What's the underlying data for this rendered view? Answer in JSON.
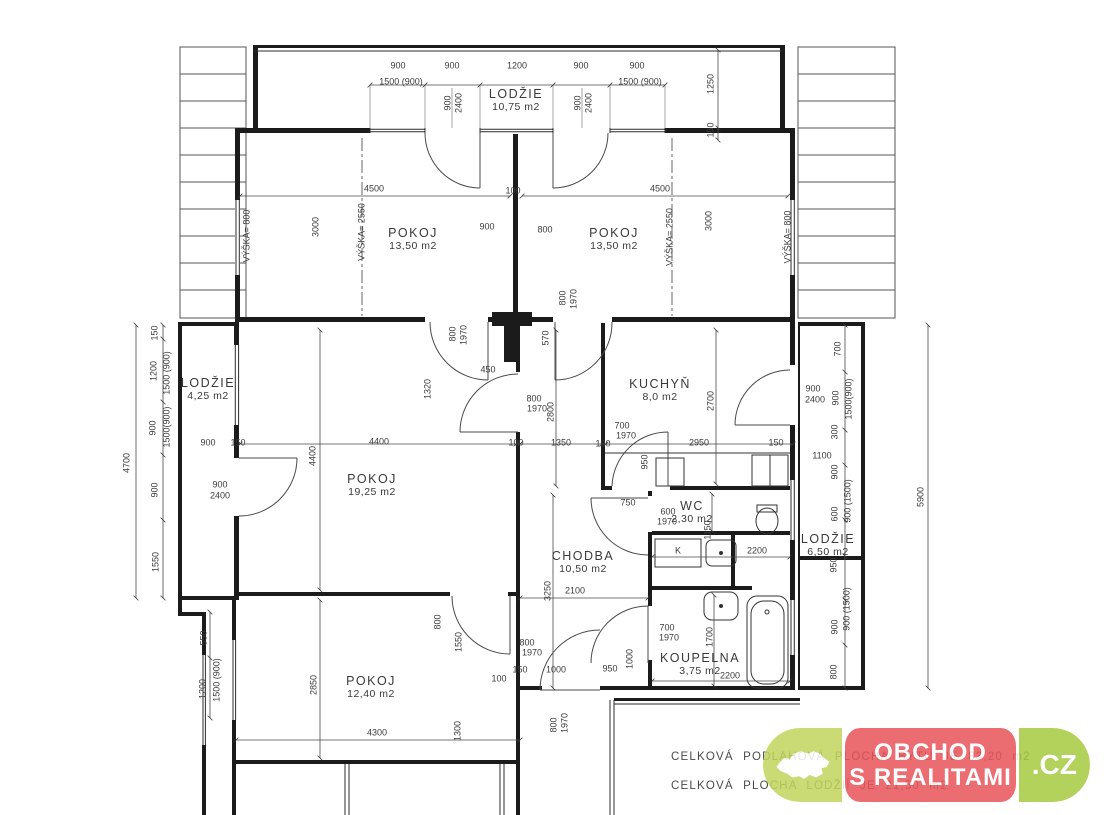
{
  "rooms": [
    {
      "id": "lodzie-top",
      "name": "LODŽIE",
      "area": "10,75 m2",
      "x": 516,
      "y": 100
    },
    {
      "id": "pokoj-upper-left",
      "name": "POKOJ",
      "area": "13,50 m2",
      "x": 413,
      "y": 239
    },
    {
      "id": "pokoj-upper-right",
      "name": "POKOJ",
      "area": "13,50 m2",
      "x": 614,
      "y": 239
    },
    {
      "id": "lodzie-left",
      "name": "LODŽIE",
      "area": "4,25 m2",
      "x": 208,
      "y": 389
    },
    {
      "id": "kuchyn",
      "name": "KUCHYŇ",
      "area": "8,0 m2",
      "x": 660,
      "y": 390
    },
    {
      "id": "pokoj-main",
      "name": "POKOJ",
      "area": "19,25 m2",
      "x": 372,
      "y": 485
    },
    {
      "id": "wc",
      "name": "WC",
      "area": "2,30 m2",
      "x": 692,
      "y": 512
    },
    {
      "id": "chodba",
      "name": "CHODBA",
      "area": "10,50 m2",
      "x": 583,
      "y": 562
    },
    {
      "id": "lodzie-right",
      "name": "LODŽIE",
      "area": "6,50 m2",
      "x": 828,
      "y": 545
    },
    {
      "id": "koupelna",
      "name": "KOUPELNA",
      "area": "3,75 m2",
      "x": 700,
      "y": 664
    },
    {
      "id": "pokoj-bottom",
      "name": "POKOJ",
      "area": "12,40 m2",
      "x": 371,
      "y": 687
    }
  ],
  "dims": [
    {
      "t": "900",
      "x": 398,
      "y": 66
    },
    {
      "t": "900",
      "x": 452,
      "y": 66
    },
    {
      "t": "1200",
      "x": 517,
      "y": 66
    },
    {
      "t": "900",
      "x": 581,
      "y": 66
    },
    {
      "t": "900",
      "x": 637,
      "y": 66
    },
    {
      "t": "1500 (900)",
      "x": 401,
      "y": 82
    },
    {
      "t": "1500 (900)",
      "x": 640,
      "y": 82
    },
    {
      "t": "900",
      "x": 448,
      "y": 103,
      "r": 1
    },
    {
      "t": "2400",
      "x": 459,
      "y": 103,
      "r": 1
    },
    {
      "t": "900",
      "x": 578,
      "y": 103,
      "r": 1
    },
    {
      "t": "2400",
      "x": 589,
      "y": 103,
      "r": 1
    },
    {
      "t": "1250",
      "x": 711,
      "y": 84,
      "r": 1
    },
    {
      "t": "150",
      "x": 711,
      "y": 130,
      "r": 1
    },
    {
      "t": "4500",
      "x": 374,
      "y": 189
    },
    {
      "t": "100",
      "x": 513,
      "y": 191
    },
    {
      "t": "4500",
      "x": 660,
      "y": 189
    },
    {
      "t": "3000",
      "x": 316,
      "y": 227,
      "r": 1
    },
    {
      "t": "VÝŠKA= 2550",
      "x": 362,
      "y": 232,
      "r": 1
    },
    {
      "t": "VÝŠKA= 800",
      "x": 247,
      "y": 236,
      "r": 1
    },
    {
      "t": "900",
      "x": 487,
      "y": 227
    },
    {
      "t": "800",
      "x": 545,
      "y": 230
    },
    {
      "t": "VÝŠKA= 2550",
      "x": 670,
      "y": 237,
      "r": 1
    },
    {
      "t": "3000",
      "x": 709,
      "y": 221,
      "r": 1
    },
    {
      "t": "VÝŠKA= 800",
      "x": 788,
      "y": 237,
      "r": 1
    },
    {
      "t": "800",
      "x": 563,
      "y": 298,
      "r": 1
    },
    {
      "t": "1970",
      "x": 574,
      "y": 299,
      "r": 1
    },
    {
      "t": "150",
      "x": 155,
      "y": 333,
      "r": 1
    },
    {
      "t": "1200",
      "x": 154,
      "y": 371,
      "r": 1
    },
    {
      "t": "1500 (900)",
      "x": 167,
      "y": 373,
      "r": 1
    },
    {
      "t": "900",
      "x": 153,
      "y": 428,
      "r": 1
    },
    {
      "t": "1500(900)",
      "x": 167,
      "y": 427,
      "r": 1
    },
    {
      "t": "4700",
      "x": 127,
      "y": 463,
      "r": 1
    },
    {
      "t": "900",
      "x": 208,
      "y": 443
    },
    {
      "t": "150",
      "x": 238,
      "y": 443
    },
    {
      "t": "900",
      "x": 220,
      "y": 485
    },
    {
      "t": "2400",
      "x": 220,
      "y": 496
    },
    {
      "t": "900",
      "x": 155,
      "y": 490,
      "r": 1
    },
    {
      "t": "1550",
      "x": 156,
      "y": 562,
      "r": 1
    },
    {
      "t": "550",
      "x": 204,
      "y": 638,
      "r": 1
    },
    {
      "t": "1500 (900)",
      "x": 217,
      "y": 680,
      "r": 1
    },
    {
      "t": "1200",
      "x": 203,
      "y": 689,
      "r": 1
    },
    {
      "t": "4400",
      "x": 379,
      "y": 442
    },
    {
      "t": "4400",
      "x": 313,
      "y": 456,
      "r": 1
    },
    {
      "t": "100",
      "x": 516,
      "y": 443
    },
    {
      "t": "1350",
      "x": 561,
      "y": 443
    },
    {
      "t": "100",
      "x": 603,
      "y": 444
    },
    {
      "t": "1320",
      "x": 428,
      "y": 389,
      "r": 1
    },
    {
      "t": "450",
      "x": 488,
      "y": 370
    },
    {
      "t": "800",
      "x": 453,
      "y": 334,
      "r": 1
    },
    {
      "t": "1970",
      "x": 464,
      "y": 335,
      "r": 1
    },
    {
      "t": "570",
      "x": 546,
      "y": 338,
      "r": 1
    },
    {
      "t": "800",
      "x": 534,
      "y": 399
    },
    {
      "t": "1970",
      "x": 537,
      "y": 409
    },
    {
      "t": "2800",
      "x": 551,
      "y": 412,
      "r": 1
    },
    {
      "t": "3250",
      "x": 548,
      "y": 591,
      "r": 1
    },
    {
      "t": "2100",
      "x": 575,
      "y": 591
    },
    {
      "t": "2700",
      "x": 711,
      "y": 401,
      "r": 1
    },
    {
      "t": "700",
      "x": 622,
      "y": 426
    },
    {
      "t": "1970",
      "x": 626,
      "y": 436
    },
    {
      "t": "2950",
      "x": 699,
      "y": 443
    },
    {
      "t": "150",
      "x": 776,
      "y": 443
    },
    {
      "t": "950",
      "x": 645,
      "y": 462,
      "r": 1
    },
    {
      "t": "900",
      "x": 813,
      "y": 389
    },
    {
      "t": "2400",
      "x": 815,
      "y": 400
    },
    {
      "t": "750",
      "x": 628,
      "y": 503
    },
    {
      "t": "600",
      "x": 668,
      "y": 512
    },
    {
      "t": "1970",
      "x": 667,
      "y": 522
    },
    {
      "t": "1150",
      "x": 708,
      "y": 530,
      "r": 1
    },
    {
      "t": "K",
      "x": 678,
      "y": 551
    },
    {
      "t": "2200",
      "x": 757,
      "y": 551
    },
    {
      "t": "700",
      "x": 838,
      "y": 349,
      "r": 1
    },
    {
      "t": "900",
      "x": 836,
      "y": 398,
      "r": 1
    },
    {
      "t": "1500(900)",
      "x": 849,
      "y": 399,
      "r": 1
    },
    {
      "t": "300",
      "x": 835,
      "y": 432,
      "r": 1
    },
    {
      "t": "1100",
      "x": 822,
      "y": 456
    },
    {
      "t": "900",
      "x": 835,
      "y": 472,
      "r": 1
    },
    {
      "t": "900 (1500)",
      "x": 848,
      "y": 501,
      "r": 1
    },
    {
      "t": "600",
      "x": 835,
      "y": 514,
      "r": 1
    },
    {
      "t": "950",
      "x": 834,
      "y": 565,
      "r": 1
    },
    {
      "t": "900 (1500)",
      "x": 847,
      "y": 609,
      "r": 1
    },
    {
      "t": "900",
      "x": 835,
      "y": 627,
      "r": 1
    },
    {
      "t": "800",
      "x": 834,
      "y": 672,
      "r": 1
    },
    {
      "t": "5900",
      "x": 921,
      "y": 497,
      "r": 1
    },
    {
      "t": "700",
      "x": 667,
      "y": 628
    },
    {
      "t": "1970",
      "x": 669,
      "y": 638
    },
    {
      "t": "1700",
      "x": 710,
      "y": 637,
      "r": 1
    },
    {
      "t": "2200",
      "x": 730,
      "y": 676
    },
    {
      "t": "950",
      "x": 610,
      "y": 669
    },
    {
      "t": "1000",
      "x": 630,
      "y": 659,
      "r": 1
    },
    {
      "t": "800",
      "x": 438,
      "y": 622,
      "r": 1
    },
    {
      "t": "1550",
      "x": 459,
      "y": 642,
      "r": 1
    },
    {
      "t": "2850",
      "x": 314,
      "y": 685,
      "r": 1
    },
    {
      "t": "4300",
      "x": 377,
      "y": 733
    },
    {
      "t": "1300",
      "x": 458,
      "y": 731,
      "r": 1
    },
    {
      "t": "100",
      "x": 499,
      "y": 679
    },
    {
      "t": "150",
      "x": 520,
      "y": 670
    },
    {
      "t": "1000",
      "x": 556,
      "y": 670
    },
    {
      "t": "800",
      "x": 527,
      "y": 643
    },
    {
      "t": "1970",
      "x": 532,
      "y": 653
    },
    {
      "t": "800",
      "x": 554,
      "y": 725,
      "r": 1
    },
    {
      "t": "1970",
      "x": 565,
      "y": 723,
      "r": 1
    }
  ],
  "footer": {
    "line1": "CELKOVÁ PODLAHOVÁ PLOCHA BYTU JE 83,20 m2",
    "line2": "CELKOVÁ PLOCHA LODŽIÍ JE 21,50 m2"
  },
  "logo": {
    "line1": "OBCHOD",
    "line2": "S REALITAMI",
    "tld": ".CZ",
    "colors": {
      "left": "#c2d45f",
      "mid": "#e8555a",
      "right": "#a6cb41"
    }
  }
}
